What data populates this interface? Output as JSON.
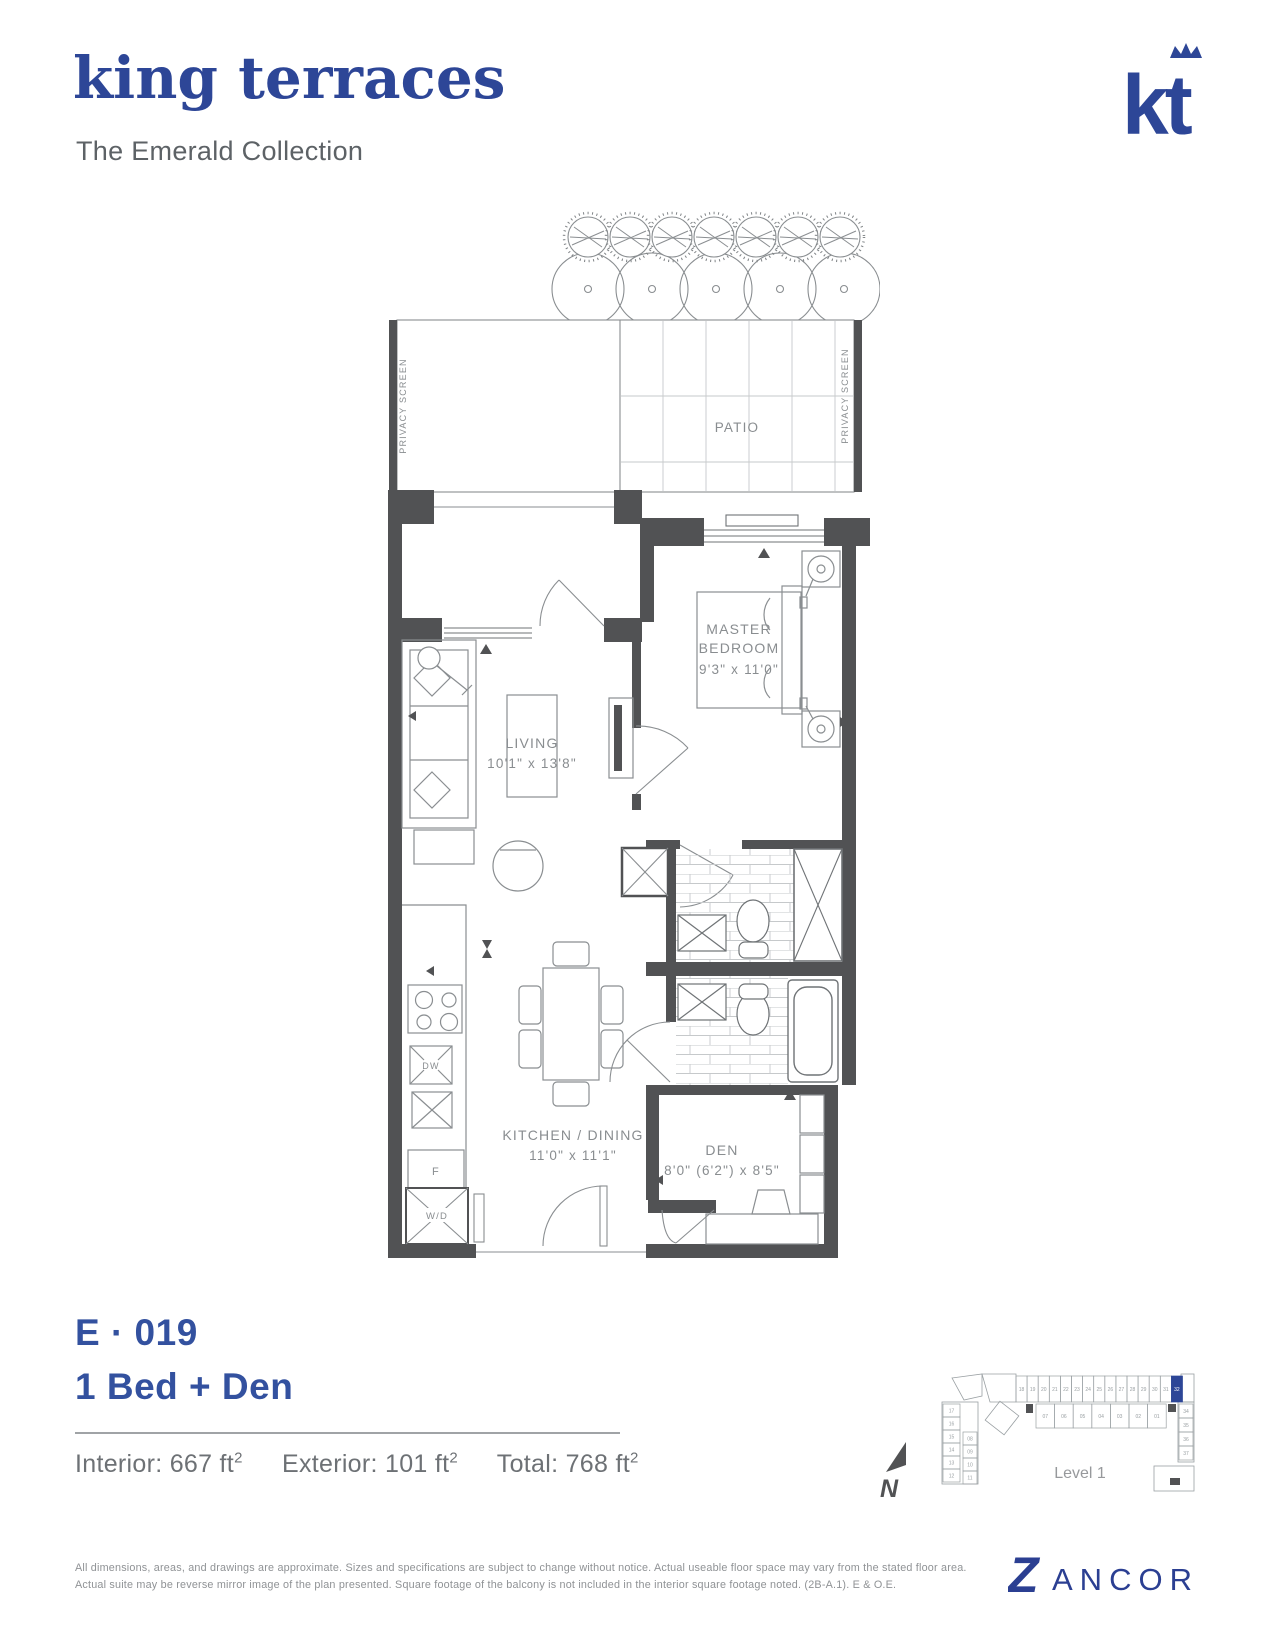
{
  "header": {
    "title": "king terraces",
    "subtitle": "The Emerald Collection",
    "logo_text": "kt"
  },
  "colors": {
    "brand_blue": "#2d4697",
    "unit_blue": "#33519f",
    "zancor_blue": "#2b3f92",
    "wall_gray": "#515254",
    "keyplan_highlight": "#2d4697"
  },
  "floorplan": {
    "patio_label": "PATIO",
    "privacy_screen_left": "PRIVACY SCREEN",
    "privacy_screen_right": "PRIVACY SCREEN",
    "rooms": {
      "master": {
        "name_line1": "MASTER",
        "name_line2": "BEDROOM",
        "dims": "9'3\" x 11'0\""
      },
      "living": {
        "name": "LIVING",
        "dims": "10'1\" x 13'8\""
      },
      "kitchen": {
        "name": "KITCHEN / DINING",
        "dims": "11'0\" x 11'1\""
      },
      "den": {
        "name": "DEN",
        "dims": "8'0\" (6'2\") x 8'5\""
      }
    },
    "appliances": {
      "dishwasher": "DW",
      "fridge": "F",
      "washer_dryer": "W/D"
    }
  },
  "unit": {
    "code": "E · 019",
    "type": "1 Bed + Den",
    "areas": {
      "interior": {
        "label": "Interior: 667 ft",
        "sup": "2"
      },
      "exterior": {
        "label": "Exterior: 101 ft",
        "sup": "2"
      },
      "total": {
        "label": "Total: 768 ft",
        "sup": "2"
      }
    }
  },
  "keyplan": {
    "level_label": "Level 1",
    "north_label": "N",
    "highlighted_unit": "32",
    "top_row": [
      "18",
      "19",
      "20",
      "21",
      "22",
      "23",
      "24",
      "25",
      "26",
      "27",
      "28",
      "29",
      "30",
      "31",
      "32"
    ],
    "inner_row": [
      "07",
      "06",
      "05",
      "04",
      "03",
      "02",
      "01"
    ],
    "left_col": [
      "17",
      "16",
      "15",
      "14",
      "13",
      "12"
    ],
    "left_inner_col": [
      "08",
      "09",
      "10",
      "11"
    ],
    "right_col": [
      "34",
      "35",
      "36",
      "37"
    ]
  },
  "footer": {
    "disclaimer": "All dimensions, areas, and drawings are approximate. Sizes and specifications are subject to change without notice. Actual useable floor space may vary from the stated floor area. Actual suite may be reverse mirror image of the plan presented. Square footage of the balcony is not included in the interior square footage noted. (2B-A.1). E & O.E.",
    "brand_z": "Z",
    "brand_rest": "ANCOR"
  }
}
